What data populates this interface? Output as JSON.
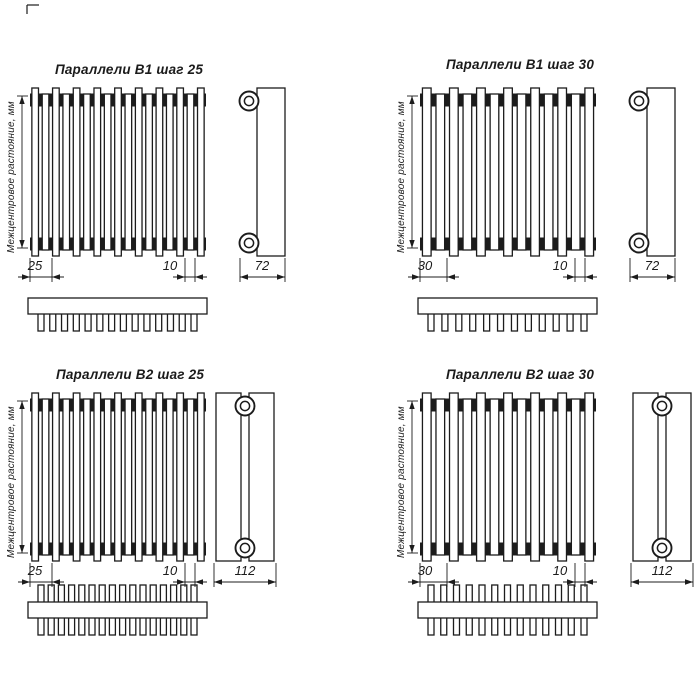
{
  "drawing": {
    "background": "#ffffff",
    "line_color": "#1c1c1c",
    "sheet_type": "radiator dimension drawings, 4 variants",
    "diagrams": [
      {
        "title": "Параллели В1 шаг 25",
        "axis_label": "Межцентровое растояние, мм",
        "variant": "В1",
        "step_dim": "25",
        "tube_width_dim": "10",
        "depth_dim": "72",
        "front_tube_count": 17,
        "top_view_tube_count": 14,
        "tube_rows": 1
      },
      {
        "title": "Параллели В1 шаг 30",
        "axis_label": "Межцентровое растояние, мм",
        "variant": "В1",
        "step_dim": "30",
        "tube_width_dim": "10",
        "depth_dim": "72",
        "front_tube_count": 13,
        "top_view_tube_count": 12,
        "tube_rows": 1
      },
      {
        "title": "Параллели В2 шаг 25",
        "axis_label": "Межцентровое растояние, мм",
        "variant": "В2",
        "step_dim": "25",
        "tube_width_dim": "10",
        "depth_dim": "112",
        "front_tube_count": 17,
        "top_view_tube_count": 16,
        "tube_rows": 2
      },
      {
        "title": "Параллели В2 шаг 30",
        "axis_label": "Межцентровое растояние, мм",
        "variant": "В2",
        "step_dim": "30",
        "tube_width_dim": "10",
        "depth_dim": "112",
        "front_tube_count": 13,
        "top_view_tube_count": 13,
        "tube_rows": 2
      }
    ]
  }
}
